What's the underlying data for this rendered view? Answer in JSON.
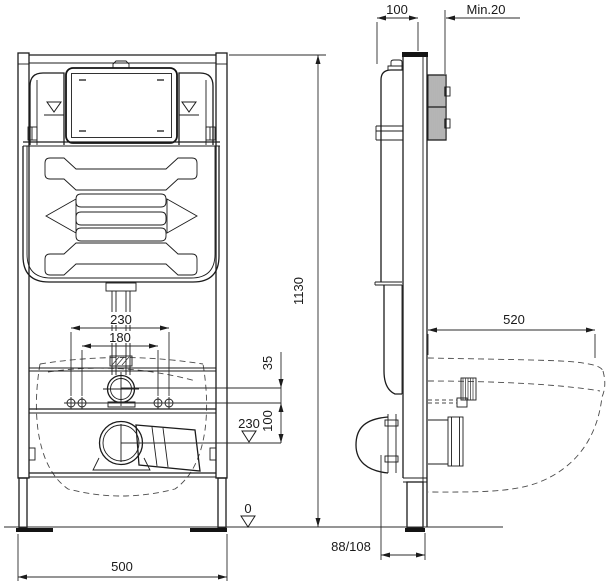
{
  "dimensions": {
    "frame_depth": "100",
    "wall_min": "Min.20",
    "frame_height": "1130",
    "bolt_spacing_outer": "230",
    "bolt_spacing_inner": "180",
    "offset_35": "35",
    "outlet_level": "230",
    "offset_100": "100",
    "floor_level": "0",
    "bowl_depth": "520",
    "frame_width": "500",
    "outlet_offset": "88/108"
  }
}
